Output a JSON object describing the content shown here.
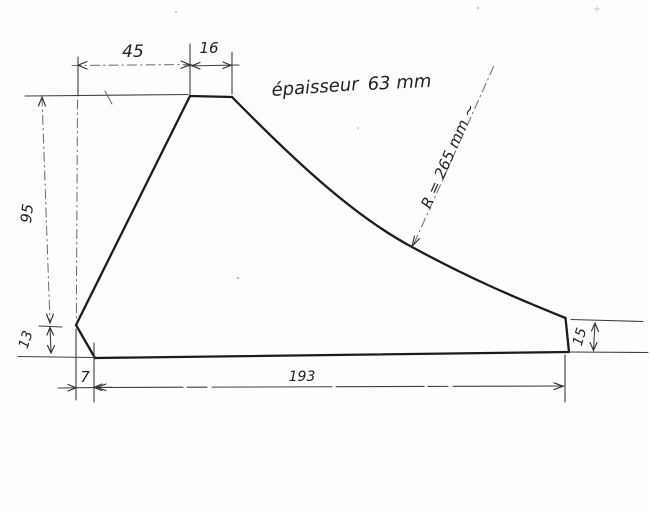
{
  "page": {
    "background": "#fdfdfb",
    "outline_ink": "#1c1c1c",
    "dimension_ink": "#3f3f3f"
  },
  "sketch": {
    "thickness_note": {
      "label": "épaisseur",
      "value": "63 mm"
    },
    "radius_note": "R = 265 mm ~",
    "dims": {
      "top_width": "45",
      "plateau_width": "16",
      "left_height": "95",
      "left_lower_height": "13",
      "bottom_left_offset": "7",
      "overall_length": "193",
      "right_height": "15"
    }
  }
}
